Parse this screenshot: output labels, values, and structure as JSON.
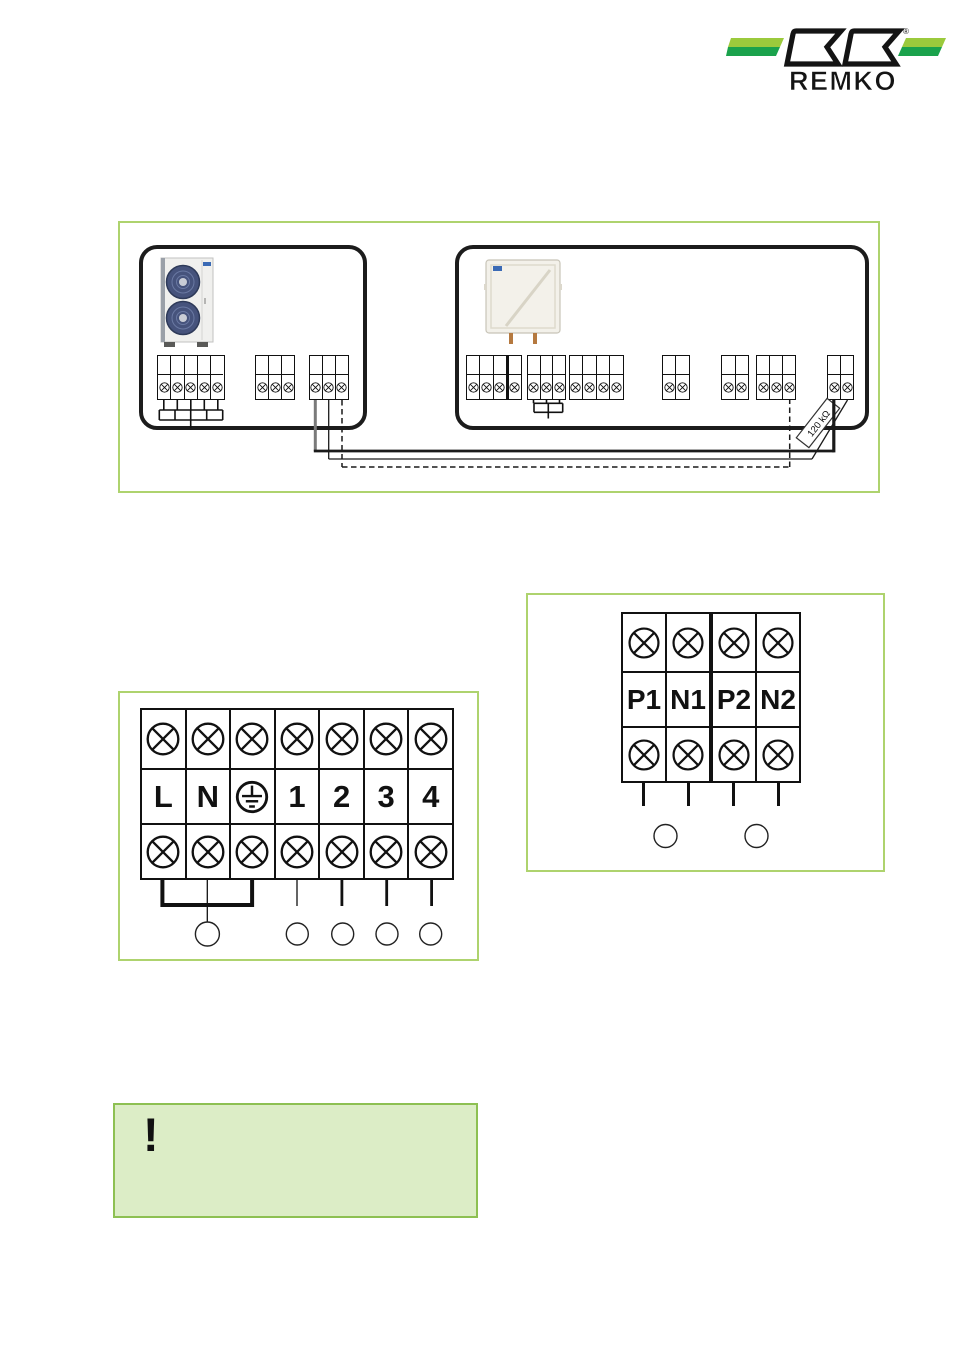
{
  "brand": {
    "name": "REMKO",
    "registered": "®"
  },
  "colors": {
    "frame_green": "#aed36e",
    "note_bg": "#dcedc6",
    "note_border": "#8dc052",
    "logo_green_light": "#9bca3c",
    "logo_green_dark": "#1aa24c",
    "wire_black": "#1a1a1a",
    "wire_gray": "#7a7a7a"
  },
  "overview": {
    "resistor_label": "120 kΩ",
    "outdoor_unit": {
      "name": "outdoor unit",
      "blocks": [
        {
          "terminals": 5,
          "note": "power block with ground comb"
        },
        {
          "terminals": 3
        },
        {
          "terminals": 3,
          "note": "bus wires leave here"
        }
      ]
    },
    "indoor_unit": {
      "name": "indoor module",
      "blocks": [
        {
          "terminals": 4,
          "thick_after": 3
        },
        {
          "terminals": 3,
          "note": "jumper comb below"
        },
        {
          "terminals": 4
        },
        {
          "terminals": 2
        },
        {
          "terminals": 2
        },
        {
          "terminals": 3,
          "note": "dashed wire target"
        },
        {
          "terminals": 2,
          "note": "bus wires + resistor"
        }
      ]
    },
    "wire_styles": [
      "solid thick",
      "solid thin",
      "dashed"
    ]
  },
  "power_terminal_diagram": {
    "labels": [
      "L",
      "N",
      "⏚",
      "1",
      "2",
      "3",
      "4"
    ],
    "callout_circles": 5
  },
  "comm_terminal_diagram": {
    "labels": [
      "P1",
      "N1",
      "P2",
      "N2"
    ],
    "callout_circles": 2
  },
  "note": {
    "mark": "!"
  }
}
